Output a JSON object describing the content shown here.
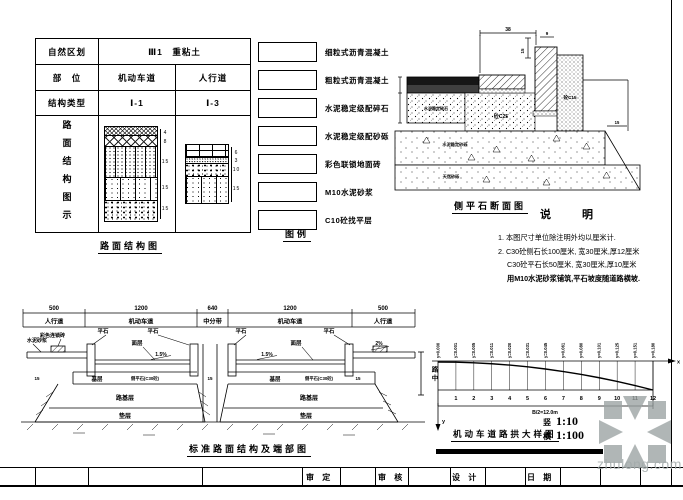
{
  "table": {
    "r1_label": "自然区划",
    "r1_value": "Ⅲ1　重粘土",
    "r2_label": "部　位",
    "r2_c1": "机动车道",
    "r2_c2": "人行道",
    "r3_label": "结构类型",
    "r3_c1": "Ⅰ-1",
    "r3_c2": "Ⅰ-3",
    "r4_label": "路面结构图示",
    "stack_left_dims": [
      "4",
      "8",
      "15",
      "15",
      "15"
    ],
    "stack_right_dims": [
      "6",
      "3",
      "10",
      "15"
    ],
    "caption": "路面结构图"
  },
  "legend": {
    "caption": "图例",
    "items": [
      "细粒式沥青混凝土",
      "粗粒式沥青混凝土",
      "水泥稳定级配碎石",
      "水泥稳定级配砂砾",
      "彩色联锁地面砖",
      "M10水泥砂浆",
      "C10砼找平层"
    ]
  },
  "curb_detail": {
    "caption": "侧平石断面图",
    "dim_top": "38",
    "dim_15": "15",
    "dim_9": "9",
    "dim_right": "15",
    "label_c25": "砼C25",
    "label_c15": "砼C15",
    "label_base": "水泥稳定碎石",
    "label_band1": "水泥稳定砂砾",
    "label_band2": "天然砂砾"
  },
  "notes": {
    "title": "说　明",
    "line1": "1. 本图尺寸单位除注明外均以厘米计.",
    "line2": "2. C30砼侧石长100厘米, 宽30厘米,厚12厘米",
    "line3": "C30砼平石长50厘米, 宽30厘米,厚10厘米",
    "line4": "用M10水泥砂浆铺筑,平石坡度随道路横坡."
  },
  "section": {
    "caption": "标准路面结构及端部图",
    "dims": [
      "500",
      "1200",
      "640",
      "1200",
      "500"
    ],
    "zones": [
      "人行道",
      "机动车道",
      "中分带",
      "机动车道",
      "人行道"
    ],
    "lbl_mortar": "水泥砂浆",
    "lbl_brick": "彩色连锁砖",
    "lbl_pingshi": "平石",
    "lbl_mianceng": "面层",
    "lbl_slope": "1.5%",
    "lbl_slope2": "2%",
    "lbl_jiceng": "基层",
    "lbl_curb": "侧平石(C30砼)",
    "lbl_lujiceng": "路基层",
    "lbl_dianceng": "垫层",
    "lbl_15": "15"
  },
  "crown": {
    "caption": "机动车道路拱大样图",
    "axis_x": "x",
    "axis_y": "y",
    "center_label": "路中",
    "span": "B/2=12.0m",
    "scale_v_name": "竖",
    "scale_v": "1:10",
    "scale_h_name": "横",
    "scale_h": "1:100",
    "stations": [
      "1",
      "2",
      "3",
      "4",
      "5",
      "6",
      "7",
      "8",
      "9",
      "10",
      "11",
      "12"
    ],
    "ordinates": [
      "y=0.000",
      "y=0.001",
      "y=0.005",
      "y=0.011",
      "y=0.020",
      "y=0.031",
      "y=0.045",
      "y=0.061",
      "y=0.080",
      "y=0.101",
      "y=0.125",
      "y=0.151",
      "y=0.180"
    ]
  },
  "titlebar": {
    "shending": "审  定",
    "shenhe": "审  核",
    "sheji": "设  计",
    "riqi": "日  期"
  },
  "watermark": {
    "text": "zhulong.com"
  }
}
